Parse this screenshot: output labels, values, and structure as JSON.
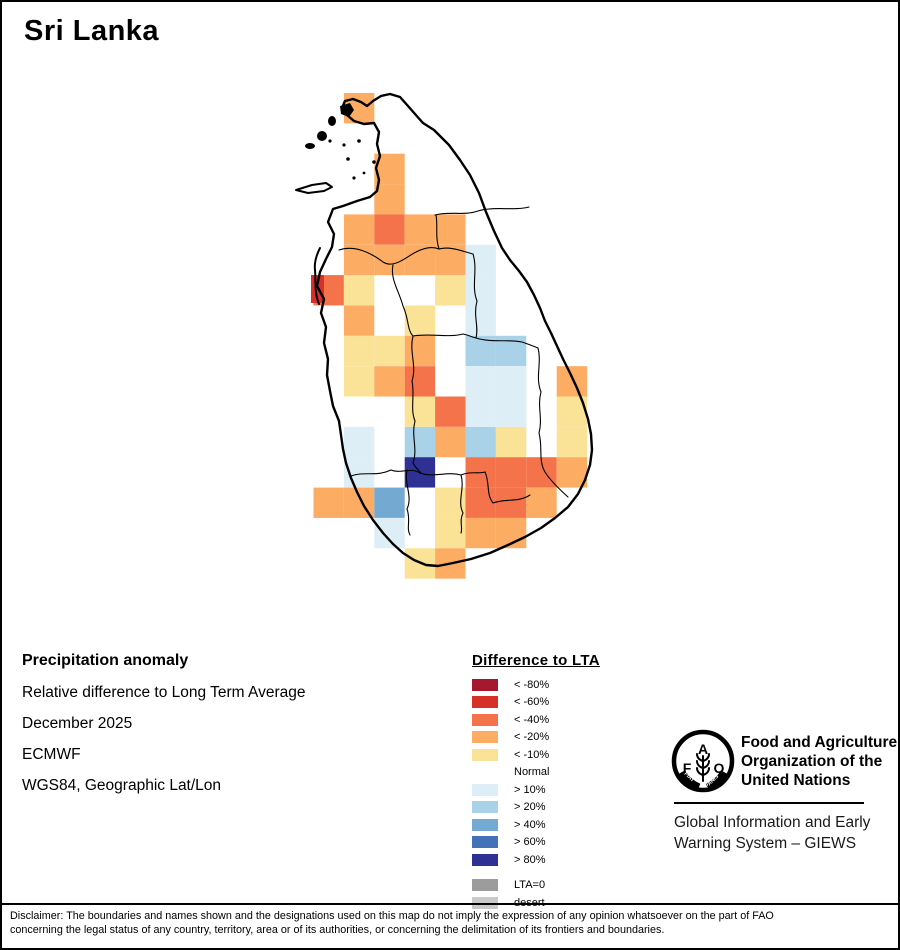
{
  "page": {
    "title": "Sri Lanka"
  },
  "colors": {
    "r80": "#a5182d",
    "r60": "#d73027",
    "o40": "#f4734a",
    "o20": "#fcad63",
    "y10": "#fae396",
    "normal": "#ffffff",
    "b10": "#ddeef7",
    "b20": "#a9d2e8",
    "b40": "#74a9d1",
    "b60": "#4472b8",
    "b80": "#2e3193",
    "gray": "#9c9c9c",
    "desert": "#c9c9c9"
  },
  "map": {
    "grid": {
      "x0": 311.5,
      "y0": 91,
      "cw": 30.4,
      "rh": 30.35
    },
    "cells": [
      [
        1,
        0,
        "o20"
      ],
      [
        2,
        2,
        "o20"
      ],
      [
        2,
        3,
        "o20"
      ],
      [
        1,
        4,
        "o20"
      ],
      [
        2,
        4,
        "o40"
      ],
      [
        3,
        4,
        "o20"
      ],
      [
        4,
        4,
        "o20"
      ],
      [
        1,
        5,
        "o20"
      ],
      [
        2,
        5,
        "o20"
      ],
      [
        3,
        5,
        "o20"
      ],
      [
        4,
        5,
        "o20"
      ],
      [
        5,
        5,
        "b10"
      ],
      [
        0,
        6,
        "o40"
      ],
      [
        1,
        6,
        "y10"
      ],
      [
        4,
        6,
        "y10"
      ],
      [
        5,
        6,
        "b10"
      ],
      [
        1,
        7,
        "o20"
      ],
      [
        3,
        7,
        "y10"
      ],
      [
        5,
        7,
        "b10"
      ],
      [
        1,
        8,
        "y10"
      ],
      [
        2,
        8,
        "y10"
      ],
      [
        3,
        8,
        "o20"
      ],
      [
        5,
        8,
        "b20"
      ],
      [
        6,
        8,
        "b20"
      ],
      [
        1,
        9,
        "y10"
      ],
      [
        2,
        9,
        "o20"
      ],
      [
        3,
        9,
        "o40"
      ],
      [
        5,
        9,
        "b10"
      ],
      [
        6,
        9,
        "b10"
      ],
      [
        8,
        9,
        "o20"
      ],
      [
        3,
        10,
        "y10"
      ],
      [
        4,
        10,
        "o40"
      ],
      [
        5,
        10,
        "b10"
      ],
      [
        6,
        10,
        "b10"
      ],
      [
        8,
        10,
        "y10"
      ],
      [
        1,
        11,
        "b10"
      ],
      [
        3,
        11,
        "b20"
      ],
      [
        4,
        11,
        "o20"
      ],
      [
        5,
        11,
        "b20"
      ],
      [
        6,
        11,
        "y10"
      ],
      [
        8,
        11,
        "y10"
      ],
      [
        1,
        12,
        "b10"
      ],
      [
        3,
        12,
        "b80"
      ],
      [
        5,
        12,
        "o40"
      ],
      [
        6,
        12,
        "o40"
      ],
      [
        7,
        12,
        "o40"
      ],
      [
        8,
        12,
        "o20"
      ],
      [
        0,
        13,
        "o20"
      ],
      [
        1,
        13,
        "o20"
      ],
      [
        2,
        13,
        "b40"
      ],
      [
        4,
        13,
        "y10"
      ],
      [
        5,
        13,
        "o40"
      ],
      [
        6,
        13,
        "o40"
      ],
      [
        7,
        13,
        "o20"
      ],
      [
        2,
        14,
        "b10"
      ],
      [
        4,
        14,
        "y10"
      ],
      [
        5,
        14,
        "o20"
      ],
      [
        6,
        14,
        "o20"
      ],
      [
        3,
        15,
        "y10"
      ],
      [
        4,
        15,
        "o20"
      ]
    ],
    "extra_cells": [
      {
        "x": 309,
        "y": 273,
        "w": 13,
        "h": 28,
        "key": "r60"
      }
    ]
  },
  "info": {
    "heading": "Precipitation anomaly",
    "lines": [
      "Relative difference to Long Term Average",
      "December 2025",
      "ECMWF",
      "WGS84, Geographic Lat/Lon"
    ]
  },
  "legend": {
    "title": "Difference to LTA",
    "items": [
      {
        "label": "< -80%",
        "key": "r80"
      },
      {
        "label": "< -60%",
        "key": "r60"
      },
      {
        "label": "< -40%",
        "key": "o40"
      },
      {
        "label": "< -20%",
        "key": "o20"
      },
      {
        "label": "< -10%",
        "key": "y10"
      },
      {
        "label": "Normal",
        "key": null
      },
      {
        "label": "> 10%",
        "key": "b10"
      },
      {
        "label": "> 20%",
        "key": "b20"
      },
      {
        "label": "> 40%",
        "key": "b40"
      },
      {
        "label": "> 60%",
        "key": "b60"
      },
      {
        "label": "> 80%",
        "key": "b80"
      }
    ],
    "footer": [
      {
        "label": "LTA=0",
        "key": "gray"
      },
      {
        "label": "desert",
        "key": "desert"
      }
    ]
  },
  "branding": {
    "logo_letters": [
      "F",
      "A",
      "O"
    ],
    "logo_motto": [
      "FIAT",
      "PANIS"
    ],
    "org_lines": [
      "Food and Agriculture",
      "Organization of the",
      "United Nations"
    ],
    "giews_lines": [
      "Global Information and Early",
      "Warning System – GIEWS"
    ]
  },
  "disclaimer": {
    "line1": "Disclaimer: The boundaries and names shown and the designations used on this map do not imply the expression of any opinion whatsoever on the part of FAO",
    "line2": "concerning the legal status of any country, territory, area or of its authorities, or concerning the delimitation of its frontiers and boundaries."
  }
}
